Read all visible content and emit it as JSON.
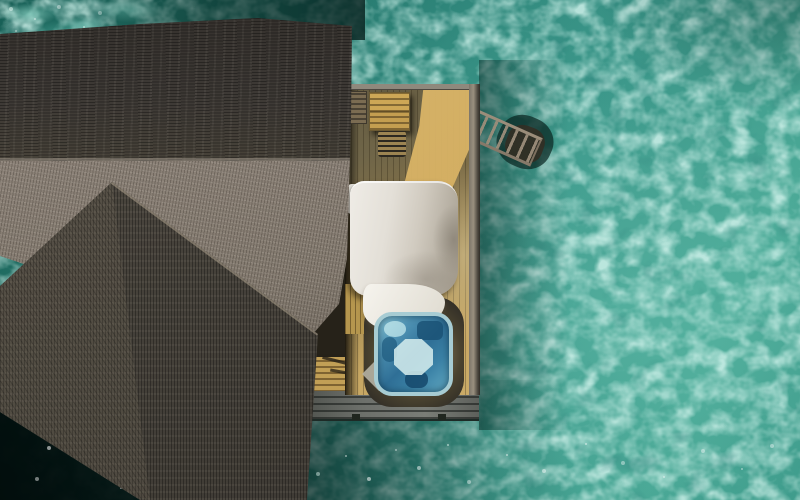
{
  "scene": {
    "type": "aerial-photo",
    "description": "Top-down drone view of an overwater villa in a turquoise lagoon: two dark thatched roofs, a wooden sun deck with a white canopy daybed, a square hot tub, slatted steps and a swim ladder descending into the water, villa shadow darkening the water at bottom left.",
    "objects": [
      "lagoon water",
      "main thatched roof",
      "annex thatched roof",
      "sun deck",
      "canopy daybed",
      "bed linen",
      "hot tub",
      "deck bench",
      "pergola box",
      "sun lounger",
      "bamboo wall",
      "wooden steps",
      "swim ladder",
      "wet deck ledge"
    ]
  },
  "palette": {
    "water_base": "#2c8277",
    "water_deep": "#175f56",
    "water_bright": "#49a795",
    "roof_dark": "#3d3935",
    "roof_light": "#8b8177",
    "annex_roof": "#45413a",
    "deck_shadow": "#645b41",
    "deck_sunlit": "#c7a763",
    "sun_patch": "#dcb76a",
    "trim_gray": "#8f897d",
    "canopy_light": "#efece6",
    "canopy_shade": "#a39b8d",
    "linen": "#f6f4ee",
    "tub_rim": "#a7ccd3",
    "tub_deep": "#2f6f96",
    "tub_light": "#8ec9d8",
    "steps_gold": "#c19f56",
    "bamboo": "#b5964e",
    "wet_deck": "#6d706b",
    "ladder_wood": "#9b8d7a",
    "dark_frame": "#332f27"
  }
}
